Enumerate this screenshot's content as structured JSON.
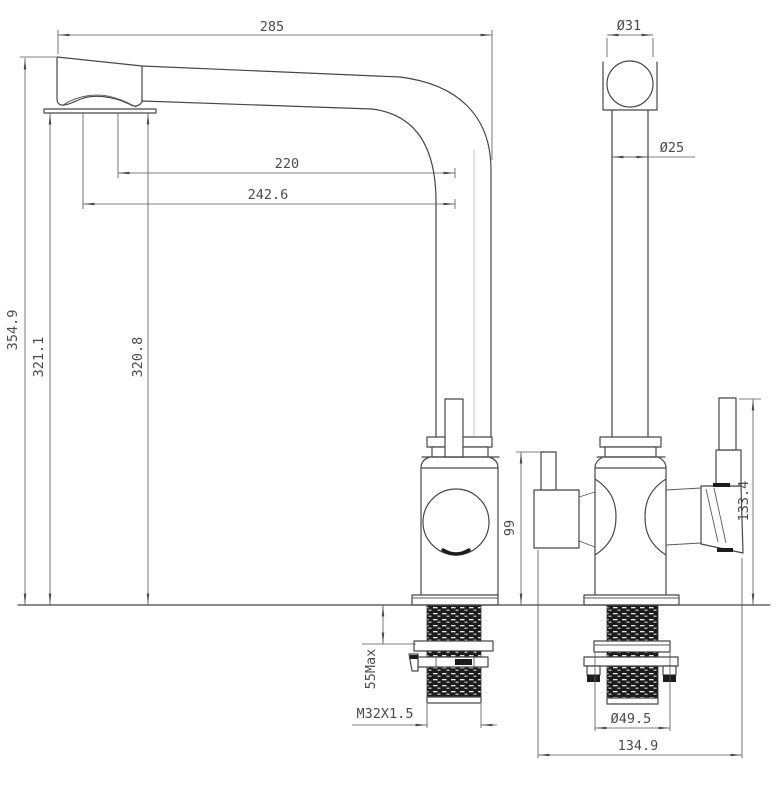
{
  "meta": {
    "type": "technical-drawing",
    "subject": "Kitchen faucet two-view dimensional drawing"
  },
  "colors": {
    "background": "#ffffff",
    "outline": "#474747",
    "dimension_line": "#585858",
    "text": "#4c4c4c",
    "thread_fill": "#1c1c1c"
  },
  "views": {
    "front": {
      "label": "front view"
    },
    "side": {
      "label": "side view"
    }
  },
  "dimensions": {
    "spout_reach_overall": "285",
    "spout_reach_center": "220",
    "spout_reach_outer": "242.6",
    "height_overall": "354.9",
    "height_spout_underside_front": "321.1",
    "height_spout_underside_inner": "320.8",
    "elbow_diameter": "Ø31",
    "riser_diameter": "Ø25",
    "filtered_lever_height": "99",
    "side_lever_height": "133.4",
    "deck_thickness_max": "55Max",
    "thread_spec": "M32X1.5",
    "flange_diameter": "Ø49.5",
    "base_span": "134.9"
  }
}
